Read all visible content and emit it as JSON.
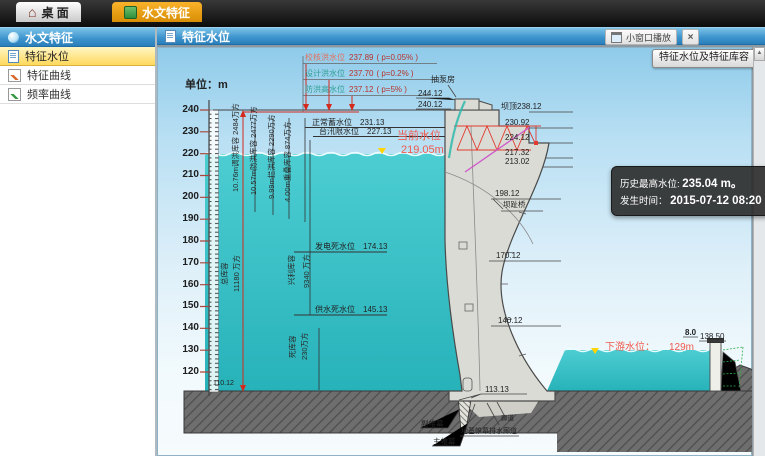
{
  "topbar": {
    "tab_desktop": "桌 面",
    "tab_hydro": "水文特征"
  },
  "sidebar": {
    "title": "水文特征",
    "items": [
      "特征水位",
      "特征曲线",
      "频率曲线"
    ]
  },
  "panel": {
    "title": "特征水位",
    "mini_window": "小窗口播放",
    "close": "×",
    "capacity_button": "特征水位及特征库容",
    "scroll_up": "▲"
  },
  "diagram": {
    "unit": "单位：m",
    "ticks": [
      "240",
      "230",
      "220",
      "210",
      "200",
      "190",
      "180",
      "170",
      "160",
      "150",
      "140",
      "130",
      "120"
    ],
    "floods": [
      {
        "name": "校核洪水位",
        "value": "237.89",
        "p": "( p=0.05% )"
      },
      {
        "name": "设计洪水位",
        "value": "237.70",
        "p": "( p=0.2% )"
      },
      {
        "name": "防洪高水位",
        "value": "237.12",
        "p": "( p=5% )"
      }
    ],
    "levels": {
      "normal": {
        "name": "正常蓄水位",
        "value": "231.13"
      },
      "flood_limit": {
        "name": "台汛限水位",
        "value": "227.13"
      },
      "power_dead": {
        "name": "发电死水位",
        "value": "174.13"
      },
      "supply_dead": {
        "name": "供水死水位",
        "value": "145.13"
      }
    },
    "current": {
      "label": "当前水位",
      "value": "219.05m"
    },
    "downstream": {
      "label": "下游水位：",
      "value": "129m"
    },
    "columns": [
      "10.76m调洪库容 2484万方",
      "10.57m防洪库容 2477万方",
      "9.99m拦洪库容 2290万方",
      "4.00m重叠库容 874万方"
    ],
    "storages": {
      "total_name": "总库容",
      "total_value": "11180 万方",
      "benefit_name": "兴利库容",
      "benefit_value": "9340 万方",
      "dead_name": "死库容",
      "dead_value": "230万方"
    },
    "structures": {
      "pump_house": "抽泵房",
      "crest": "坝顶238.12",
      "bridge": "坝趾桥",
      "gallery": "廊道",
      "drain_gallery": "地基帷幕排水廊道",
      "aux_curtain": "副帷幕",
      "main_curtain": "主帷幕"
    },
    "elevations": {
      "e244": "244.12",
      "e240": "240.12",
      "e230": "230.92",
      "e224": "224.12",
      "e217": "217.32",
      "e213": "213.02",
      "e198": "198.12",
      "e170": "170.12",
      "e140": "140.12",
      "e113": "113.13",
      "e110": "110.12",
      "tail_top": "8.0",
      "tail_level": "138.50"
    },
    "info": {
      "l1_label": "历史最高水位:",
      "l1_value": "235.04 m。",
      "l2_label": "发生时间：",
      "l2_value": "2015-07-12 08:20"
    }
  }
}
